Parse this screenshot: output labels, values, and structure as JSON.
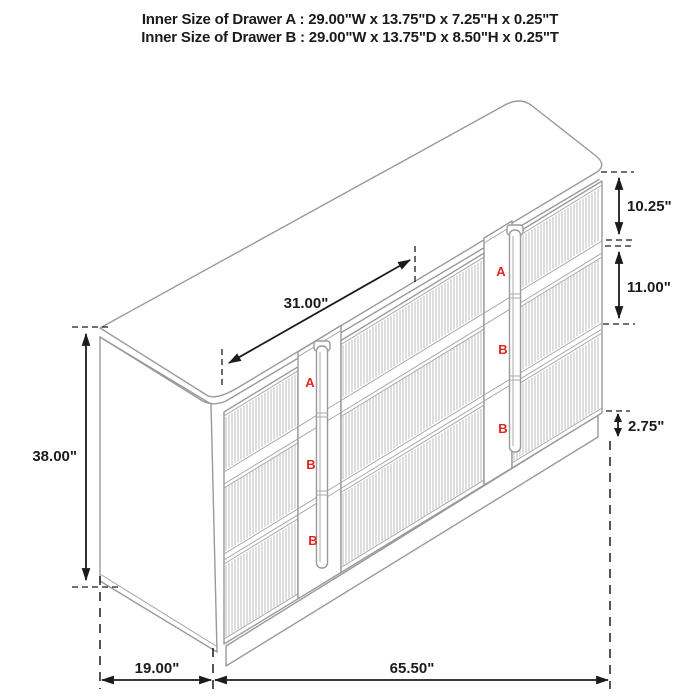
{
  "title": {
    "line1": "Inner Size of Drawer A : 29.00\"W x 13.75\"D x 7.25\"H x 0.25\"T",
    "line2": "Inner Size of Drawer B : 29.00\"W x 13.75\"D x 8.50\"H x 0.25\"T"
  },
  "dimensions": {
    "top_span": {
      "label": "31.00\""
    },
    "height": {
      "label": "38.00\""
    },
    "drawer_a_height": {
      "label": "10.25\""
    },
    "drawer_b_height": {
      "label": "11.00\""
    },
    "base_height": {
      "label": "2.75\""
    },
    "depth": {
      "label": "19.00\""
    },
    "width": {
      "label": "65.50\""
    }
  },
  "drawer_markers": {
    "left": [
      "A",
      "B",
      "B"
    ],
    "right": [
      "A",
      "B",
      "B"
    ]
  },
  "colors": {
    "cabinet_line": "#9a9a9a",
    "flute_line": "#b5b5b5",
    "dimension_line": "#1b1b1b",
    "marker_red": "#e02620",
    "background": "#ffffff"
  }
}
